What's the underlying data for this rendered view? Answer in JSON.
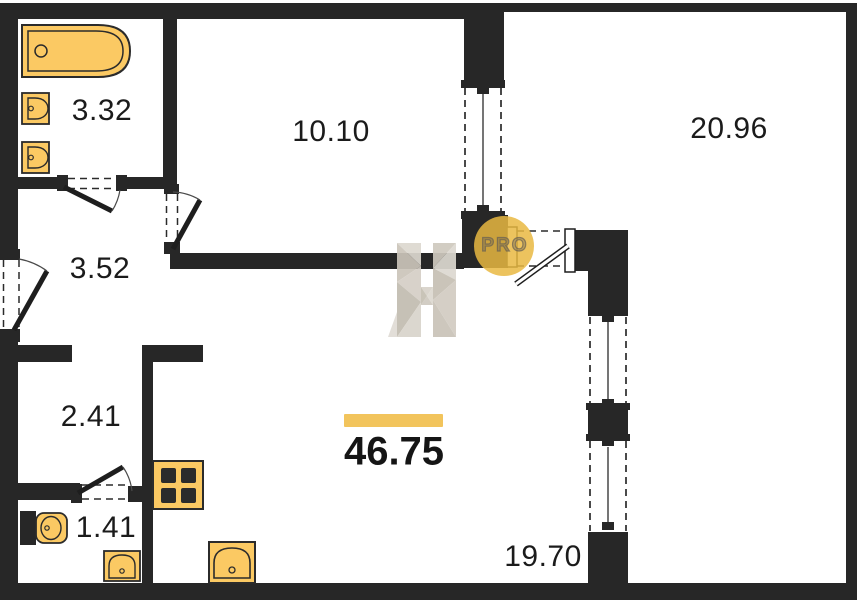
{
  "floorplan": {
    "total_area_label": "46.75",
    "rooms": [
      {
        "id": "bathroom",
        "area_label": "3.32"
      },
      {
        "id": "room-top",
        "area_label": "10.10"
      },
      {
        "id": "room-right",
        "area_label": "20.96"
      },
      {
        "id": "hallway",
        "area_label": "3.52"
      },
      {
        "id": "closet",
        "area_label": "2.41"
      },
      {
        "id": "wc",
        "area_label": "1.41"
      },
      {
        "id": "kitchen-living",
        "area_label": "19.70"
      }
    ],
    "watermark": {
      "badge_text": "PRO"
    },
    "colors": {
      "wall": "#272727",
      "fixture": "#FBC963",
      "fixture_stroke": "#2b2b2b",
      "accent": "#F2C45C",
      "badge": "#E9B842",
      "watermark_grey": "#D7D2C9"
    }
  }
}
